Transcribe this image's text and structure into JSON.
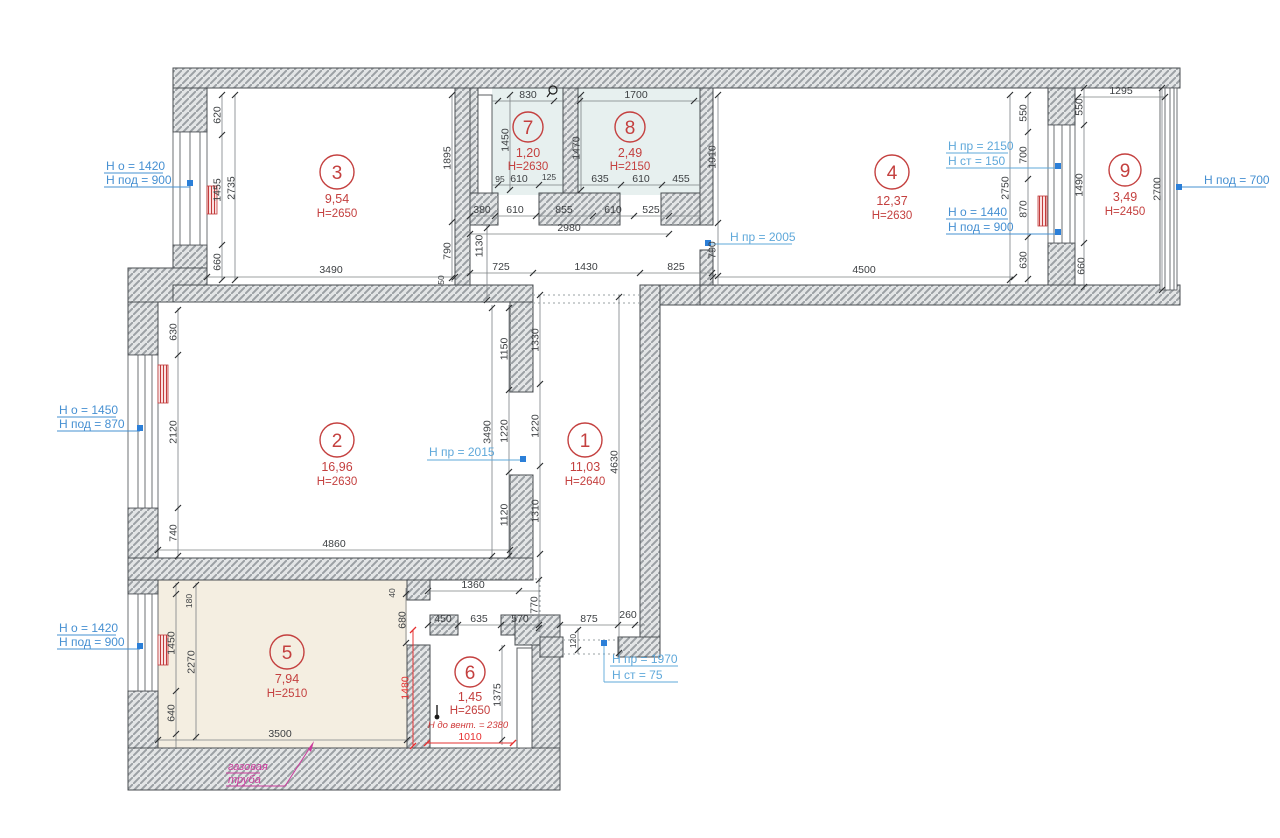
{
  "drawing": {
    "rooms": {
      "r1": {
        "number": "1",
        "area": "11,03",
        "height": "H=2640"
      },
      "r2": {
        "number": "2",
        "area": "16,96",
        "height": "H=2630"
      },
      "r3": {
        "number": "3",
        "area": "9,54",
        "height": "H=2650"
      },
      "r4": {
        "number": "4",
        "area": "12,37",
        "height": "H=2630"
      },
      "r5": {
        "number": "5",
        "area": "7,94",
        "height": "H=2510"
      },
      "r6": {
        "number": "6",
        "area": "1,45",
        "height": "H=2650",
        "vent_note": "Н до вент. = 2380"
      },
      "r7": {
        "number": "7",
        "area": "1,20",
        "height": "H=2630"
      },
      "r8": {
        "number": "8",
        "area": "2,49",
        "height": "H=2150"
      },
      "r9": {
        "number": "9",
        "area": "3,49",
        "height": "H=2450"
      }
    },
    "annotations": {
      "win3": {
        "line1": "Н о = 1420",
        "line2": "Н под = 900"
      },
      "win2": {
        "line1": "Н о = 1450",
        "line2": "Н под = 870"
      },
      "win5": {
        "line1": "Н о = 1420",
        "line2": "Н под = 900"
      },
      "door4": {
        "line1": "Н пр = 2005"
      },
      "balc4": {
        "line1": "Н пр = 2150",
        "line2": "Н ст = 150"
      },
      "win4": {
        "line1": "Н о = 1440",
        "line2": "Н под = 900"
      },
      "win9": {
        "line1": "Н под = 700"
      },
      "door2": {
        "line1": "Н пр = 2015"
      },
      "entry": {
        "line1": "Н пр = 1970",
        "line2": "Н ст = 75"
      },
      "gas": {
        "line1": "газовая",
        "line2": "труба"
      }
    },
    "dims": {
      "r3": [
        "620",
        "1455",
        "660",
        "2735",
        "1895",
        "790",
        "50",
        "3490"
      ],
      "r7": [
        "830",
        "1450",
        "95",
        "610",
        "125"
      ],
      "r8": [
        "1700",
        "1470",
        "635",
        "610",
        "455"
      ],
      "hall_top": [
        "380",
        "610",
        "855",
        "610",
        "525",
        "2980",
        "1130",
        "725",
        "1430",
        "825"
      ],
      "r4": [
        "1910",
        "790",
        "4500",
        "550",
        "700",
        "870",
        "630",
        "2750"
      ],
      "r9": [
        "1295",
        "550",
        "1490",
        "660",
        "2700"
      ],
      "r2": [
        "630",
        "2120",
        "740",
        "1150",
        "1220",
        "1120",
        "3490",
        "4860"
      ],
      "r1": [
        "1330",
        "1220",
        "1310",
        "4630"
      ],
      "r5": [
        "180",
        "1450",
        "2270",
        "640",
        "3500",
        "40",
        "680",
        "1480"
      ],
      "hall_bottom": [
        "1360",
        "770",
        "570",
        "450",
        "635",
        "875",
        "260",
        "120"
      ],
      "r6": [
        "1375",
        "1010"
      ]
    },
    "colors": {
      "wall_hatch": "#9ba0a4",
      "room78_fill": "#e7f0ef",
      "room5_fill": "#f4eee1",
      "annotation_blue": "#4690d2",
      "annotation_cyan": "#5fa8da",
      "red_dim": "#e63030",
      "gas_magenta": "#cb3a9c",
      "room_label_red": "#c4403f"
    }
  }
}
